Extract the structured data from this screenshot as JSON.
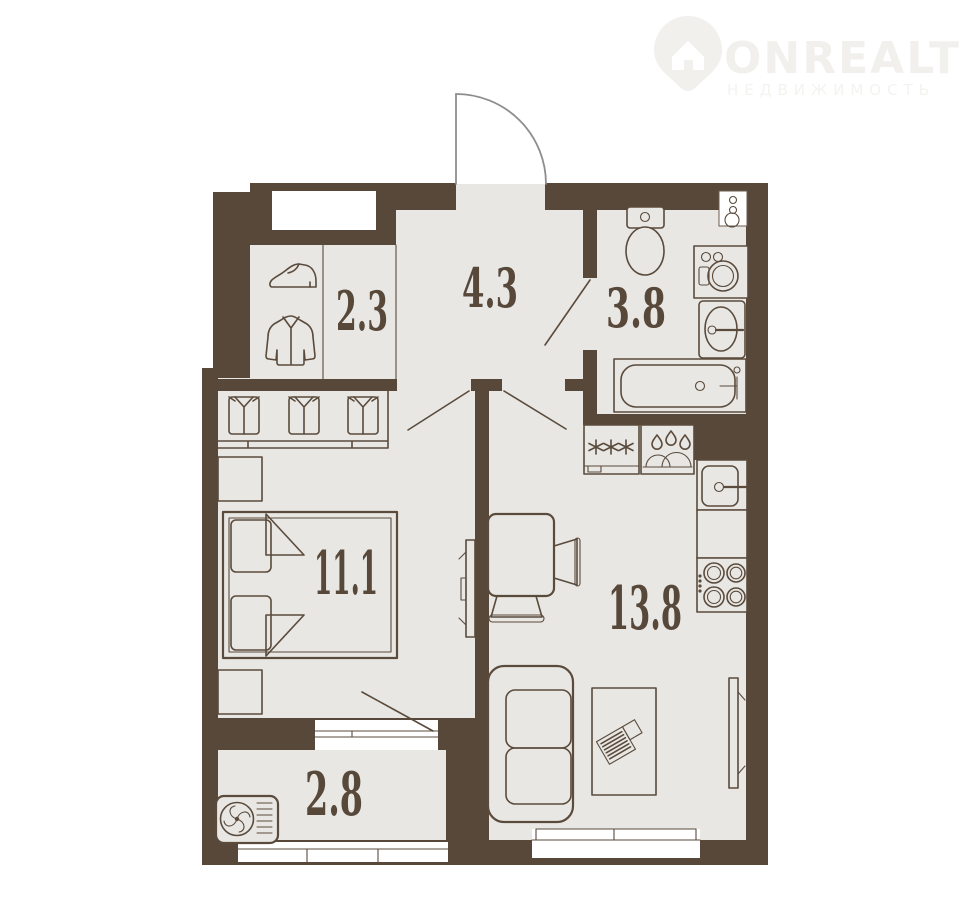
{
  "logo": {
    "brand": "ONREALT",
    "tagline": "НЕДВИЖИМОСТЬ",
    "icon": "house-pin-icon"
  },
  "floorplan": {
    "rooms": [
      {
        "name": "hallway",
        "area_label": "2.3"
      },
      {
        "name": "corridor",
        "area_label": "4.3"
      },
      {
        "name": "bathroom",
        "area_label": "3.8"
      },
      {
        "name": "bedroom",
        "area_label": "11.1"
      },
      {
        "name": "kitchen-living-room",
        "area_label": "13.8"
      },
      {
        "name": "balcony",
        "area_label": "2.8"
      }
    ],
    "fixtures": [
      "entrance-door",
      "wall-niche",
      "electrical-panel",
      "shoe-icon",
      "jacket-icon",
      "wardrobe-shirts",
      "toilet",
      "washing-machine",
      "bathroom-sink",
      "bathtub",
      "fridge",
      "dish-drying-rack",
      "kitchen-sink",
      "stove",
      "dining-table",
      "chairs",
      "tv-bedroom",
      "tv-living-room",
      "double-bed",
      "nightstands",
      "sofa",
      "coffee-table-laptop",
      "air-conditioner",
      "windows",
      "door-swings"
    ],
    "colors": {
      "wall": "#57483A",
      "floor": "#E8E7E4",
      "outline": "#5A4B3C",
      "door_arc": "#8E8E8E",
      "logo_text": "#F1F0ED"
    }
  }
}
